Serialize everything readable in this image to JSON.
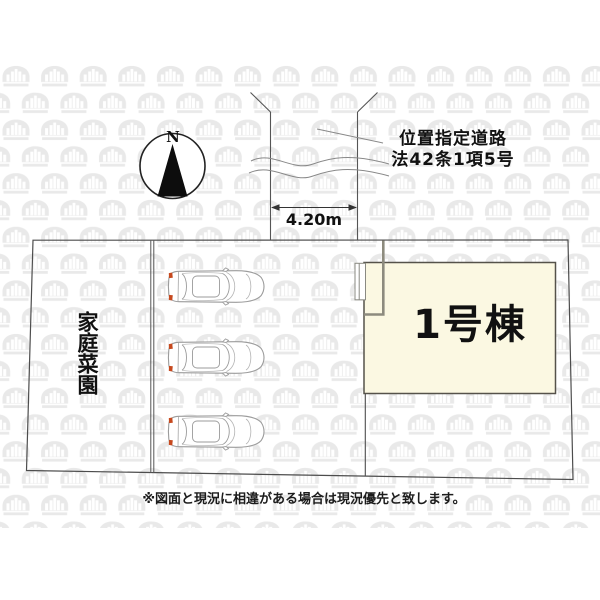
{
  "compass": {
    "label": "N"
  },
  "road": {
    "label_line1": "位置指定道路",
    "label_line2": "法42条1項5号",
    "width_label": "4.20m"
  },
  "site": {
    "garden_label": "家庭菜園",
    "building_label": "1号棟",
    "parking_car_count": 3
  },
  "footer": {
    "disclaimer": "※図面と現況に相違がある場合は現況優先と致します。"
  },
  "colors": {
    "building_fill": "#FBF8E2",
    "outline": "#4D4D4D",
    "watermark": "#E9E9E9",
    "car_accent": "#C6491E"
  }
}
